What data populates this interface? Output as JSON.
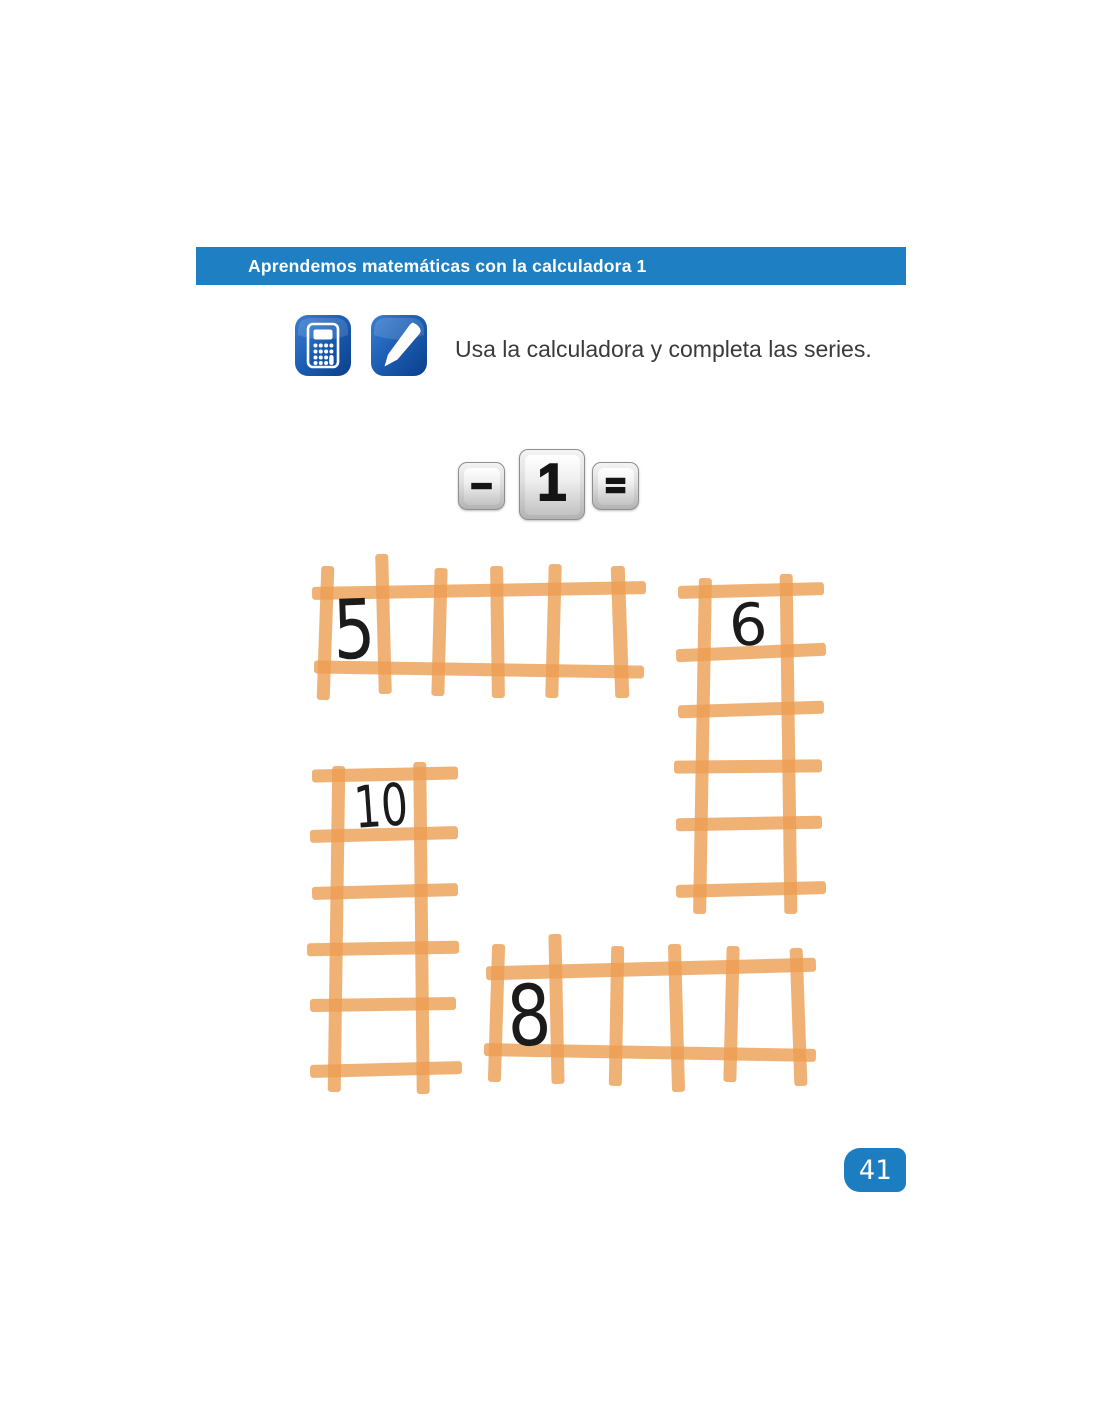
{
  "page": {
    "number": "41",
    "background": "#ffffff"
  },
  "header": {
    "title": "Aprendemos matemáticas con la calculadora 1",
    "bar_color": "#1f7fc3",
    "text_color": "#ffffff"
  },
  "instruction": {
    "text": "Usa la calculadora y completa las series.",
    "icons": [
      "calculator-icon",
      "pencil-icon"
    ],
    "icon_color": "#11459a"
  },
  "operation": {
    "keys": [
      {
        "label": "−",
        "size": "small"
      },
      {
        "label": "1",
        "size": "large"
      },
      {
        "label": "=",
        "size": "small"
      }
    ]
  },
  "series": {
    "ladder_color": "#ec9e52",
    "number_color": "#1b1b1b",
    "ladders": [
      {
        "position": "top-left",
        "orientation": "horizontal",
        "start_number": "5",
        "cells": 5,
        "filled_cells": 1,
        "empty_cells": 4
      },
      {
        "position": "top-right",
        "orientation": "vertical",
        "start_number": "6",
        "cells": 5,
        "filled_cells": 1,
        "empty_cells": 4
      },
      {
        "position": "middle-left",
        "orientation": "vertical",
        "start_number": "10",
        "cells": 5,
        "filled_cells": 1,
        "empty_cells": 4
      },
      {
        "position": "bottom-right",
        "orientation": "horizontal",
        "start_number": "8",
        "cells": 5,
        "filled_cells": 1,
        "empty_cells": 4
      }
    ]
  }
}
